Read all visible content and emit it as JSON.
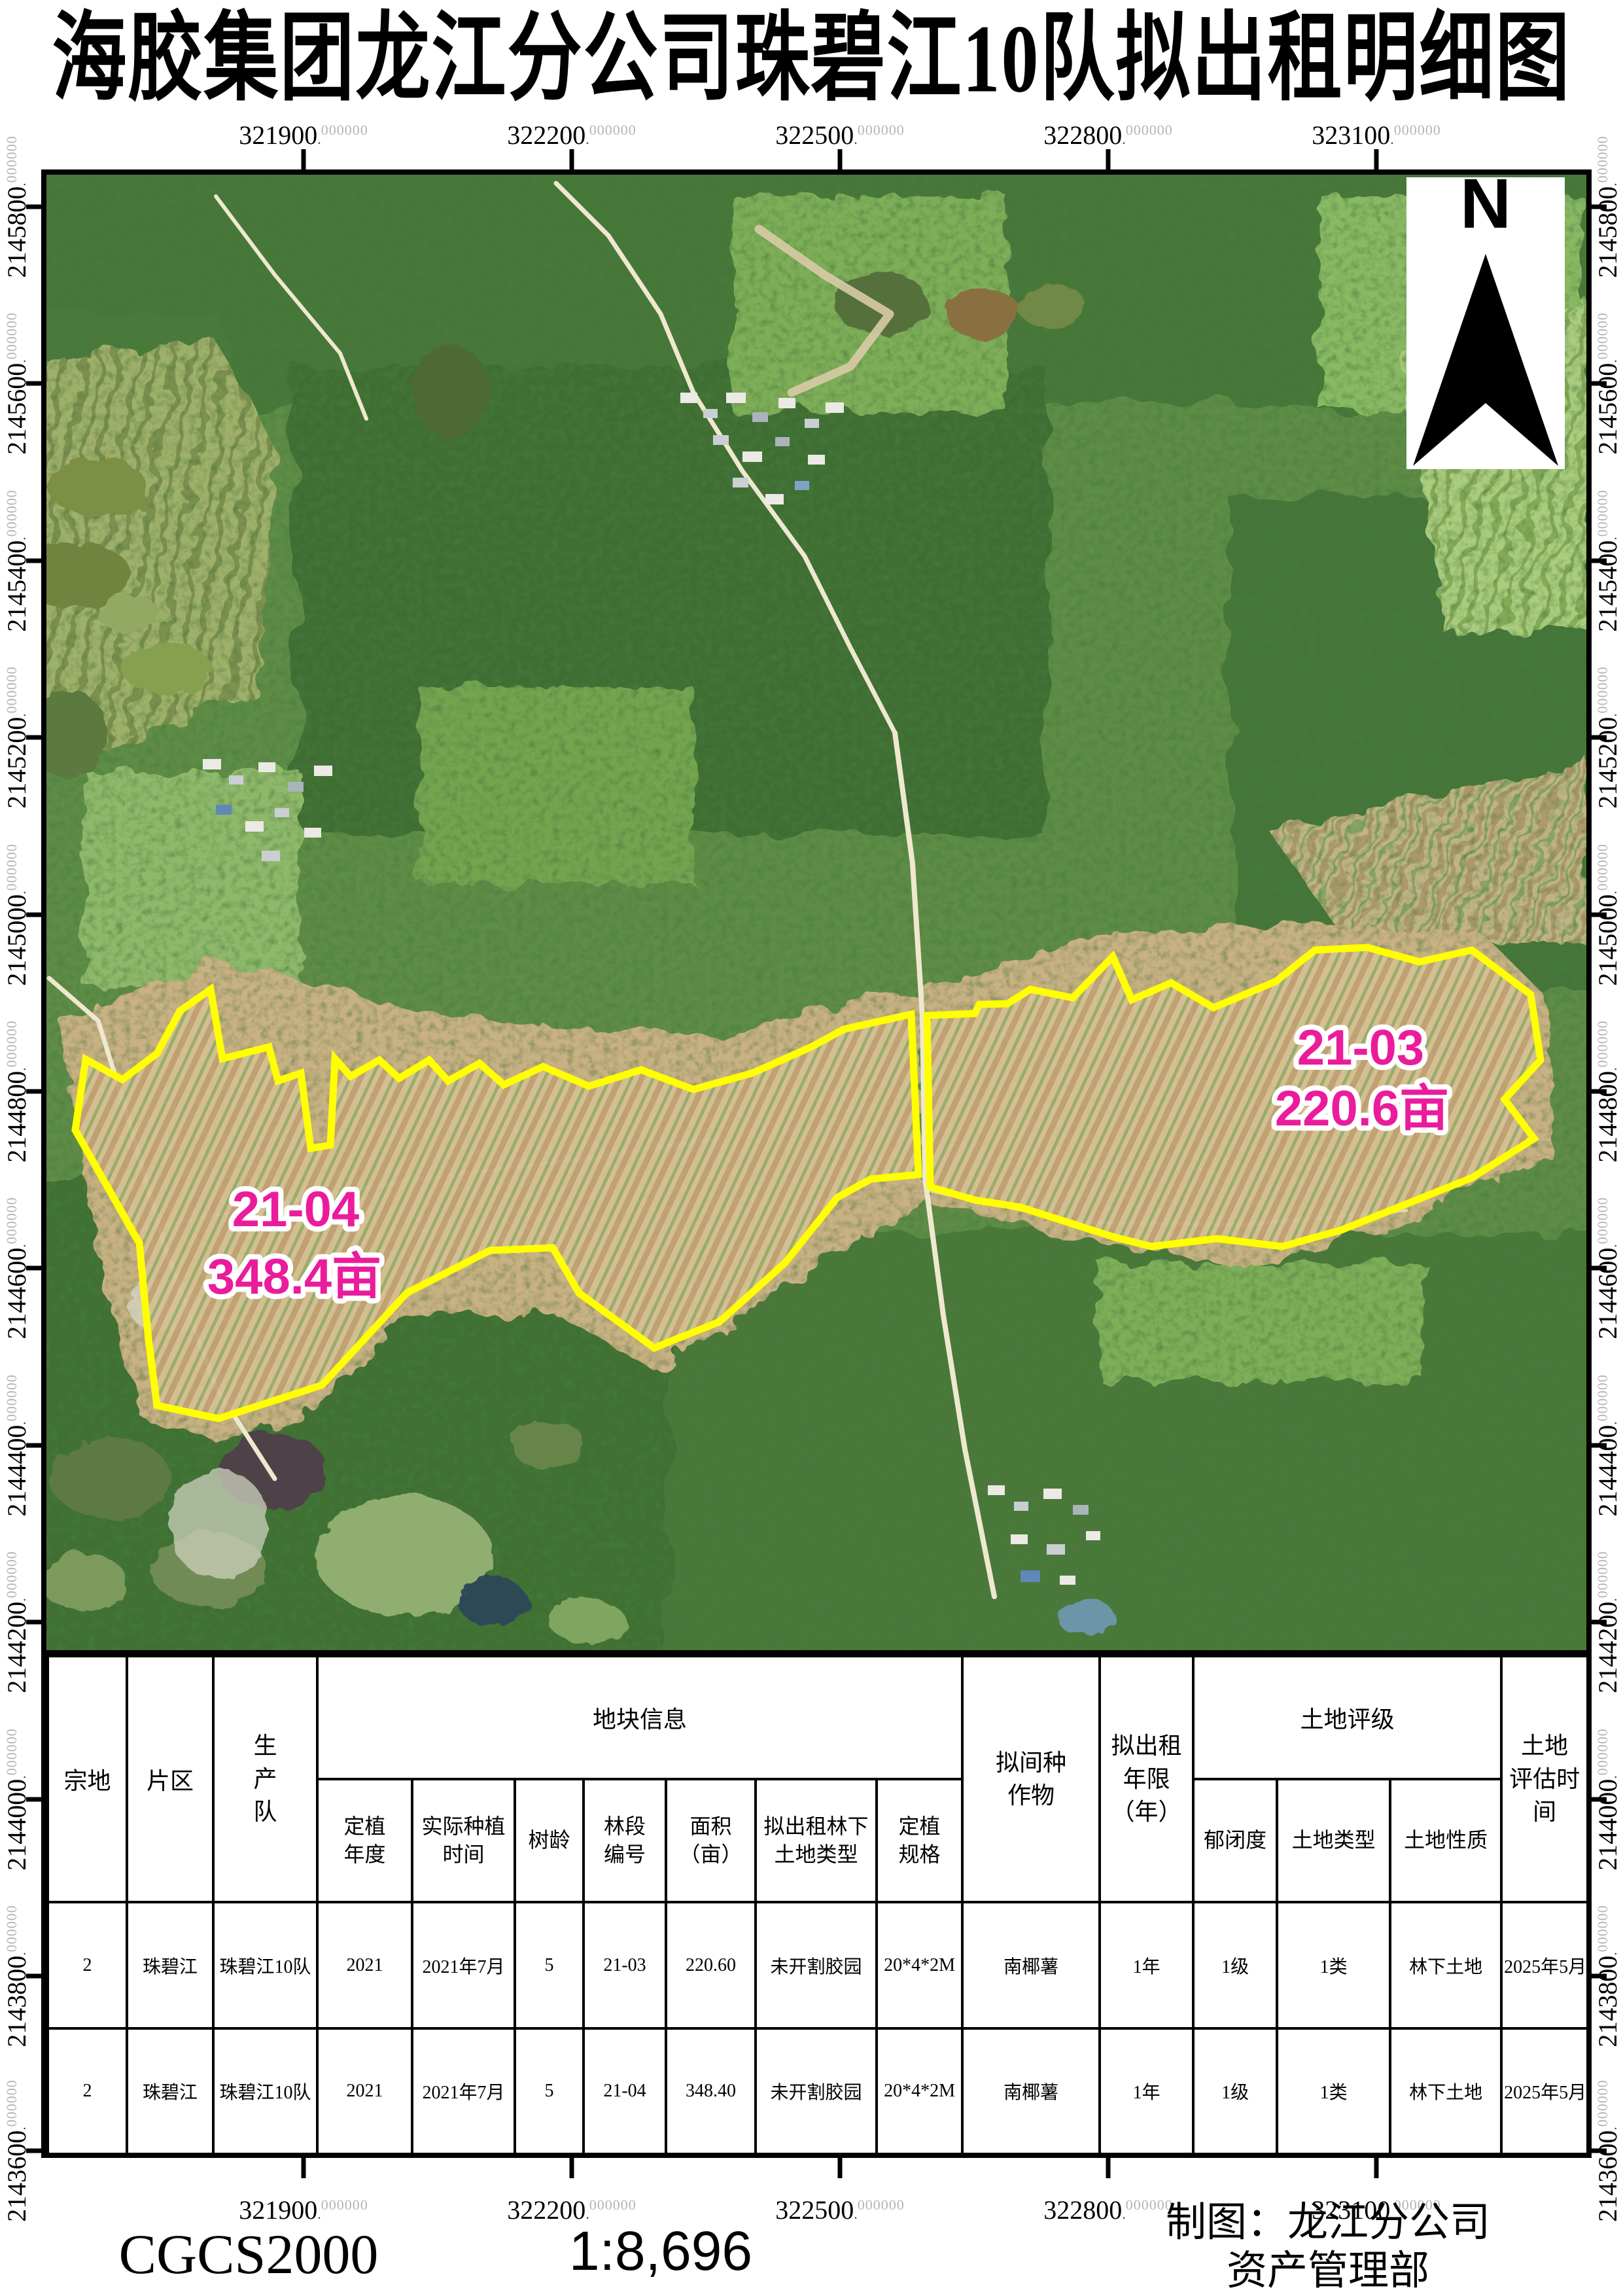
{
  "title": "海胶集团龙江分公司珠碧江10队拟出租明细图",
  "map": {
    "north_label": "N",
    "boundary_color": "#ffff00",
    "label_color": "#ea1c9c",
    "parcels": [
      {
        "id": "21-03",
        "area": "220.6亩"
      },
      {
        "id": "21-04",
        "area": "348.4亩"
      }
    ],
    "grid": {
      "dot": ".",
      "suffix": "000000",
      "x_labels": [
        "321900",
        "322200",
        "322500",
        "322800",
        "323100"
      ],
      "y_labels": [
        "2145800",
        "2145600",
        "2145400",
        "2145200",
        "2145000",
        "2144800",
        "2144600",
        "2144400",
        "2144200",
        "2144000",
        "2143800",
        "2143600"
      ]
    }
  },
  "table": {
    "group_headers": {
      "parcel": "宗地",
      "district": "片区",
      "team": "生产队",
      "plot_info": "地块信息",
      "intercrop": "拟间种作物",
      "lease_years": "拟出租年限\n（年）",
      "land_rating": "土地评级",
      "eval_time": "土地\n评估时\n间"
    },
    "sub_headers": {
      "plant_year": "定植年度",
      "actual_plant_time": "实际种植时间",
      "tree_age": "树龄",
      "section_no": "林段编号",
      "area_mu": "面积（亩）",
      "rent_land_type": "拟出租林下土地类型",
      "plant_spec": "定植规格",
      "canopy": "郁闭度",
      "land_type": "土地类型",
      "land_nature": "土地性质"
    },
    "rows": [
      {
        "c0": "2",
        "c1": "珠碧江",
        "c2": "珠碧江10队",
        "c3": "2021",
        "c4": "2021年7月",
        "c5": "5",
        "c6": "21-03",
        "c7": "220.60",
        "c8": "未开割胶园",
        "c9": "20*4*2M",
        "c10": "南椰薯",
        "c11": "1年",
        "c12": "1级",
        "c13": "1类",
        "c14": "林下土地",
        "c15": "2025年5月"
      },
      {
        "c0": "2",
        "c1": "珠碧江",
        "c2": "珠碧江10队",
        "c3": "2021",
        "c4": "2021年7月",
        "c5": "5",
        "c6": "21-04",
        "c7": "348.40",
        "c8": "未开割胶园",
        "c9": "20*4*2M",
        "c10": "南椰薯",
        "c11": "1年",
        "c12": "1级",
        "c13": "1类",
        "c14": "林下土地",
        "c15": "2025年5月"
      }
    ]
  },
  "footer": {
    "crs": "CGCS2000",
    "scale": "1:8,696",
    "credit_line1": "制图：龙江分公司",
    "credit_line2": "资产管理部"
  }
}
